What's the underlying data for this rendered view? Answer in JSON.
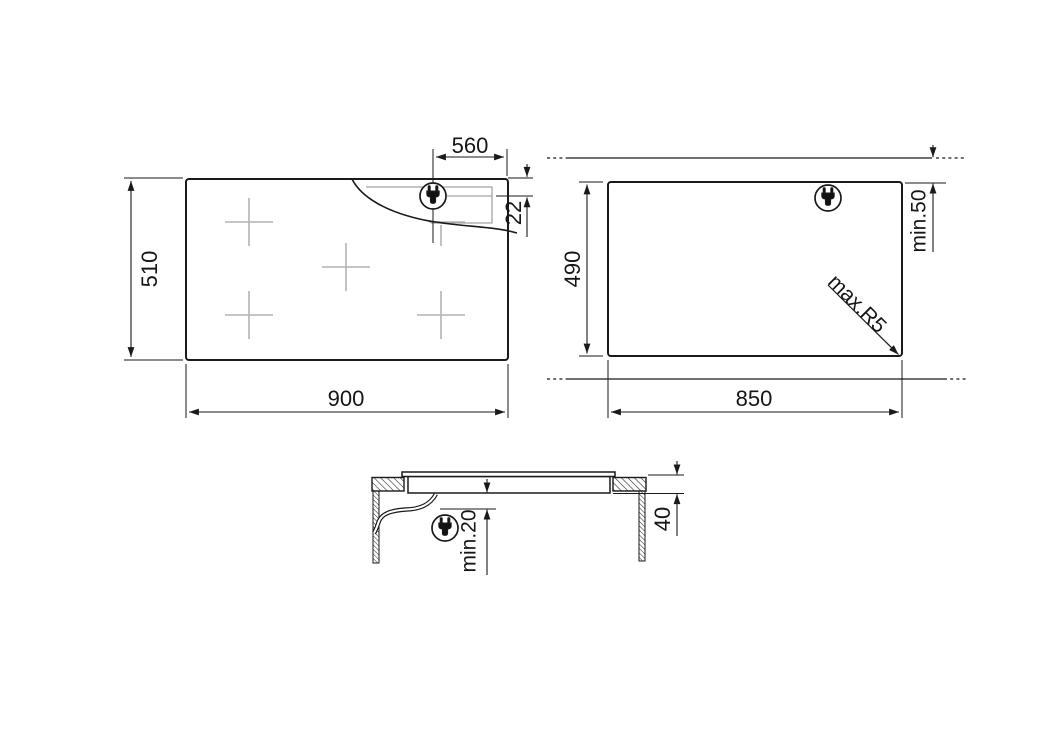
{
  "document": {
    "type": "installation-dimension-drawing",
    "product": "5-zone built-in hob",
    "unit_system": "mm",
    "background": "#ffffff"
  },
  "colors": {
    "line": "#1a1a1a",
    "dim_line": "#1a1a1a",
    "hidden_detail_gray": "#a3a3a3"
  },
  "icons": {
    "plug": "power-plug-icon"
  },
  "views": {
    "plan": {
      "name": "hob-top-view",
      "burner_count": 5,
      "height_mm": "510",
      "width_mm": "900",
      "plug_to_edge_mm": "560",
      "plug_depth_mm": "22"
    },
    "cutout": {
      "name": "worktop-cutout-view",
      "height_mm": "490",
      "width_mm": "850",
      "rear_clearance": "min.50",
      "corner_radius": "max.R5"
    },
    "section": {
      "name": "installation-section-view",
      "clearance_below": "min.20",
      "recess_depth_mm": "40"
    }
  }
}
